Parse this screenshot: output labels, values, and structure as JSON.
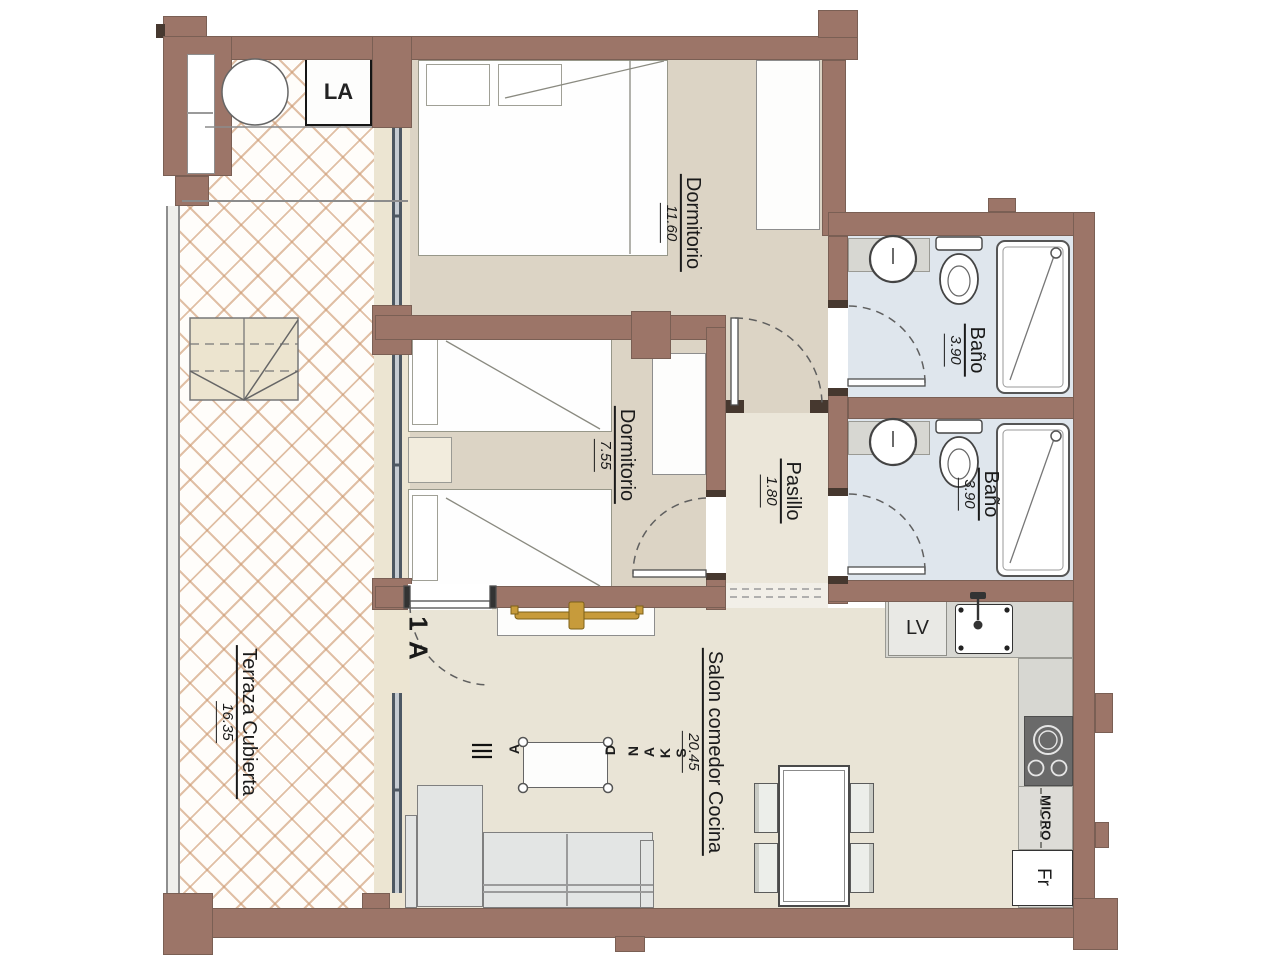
{
  "plan": {
    "unit_label": "1 A",
    "rooms": [
      {
        "id": "terraza",
        "name": "Terraza Cubierta",
        "area": "16.35"
      },
      {
        "id": "dormitorio_1",
        "name": "Dormitorio",
        "area": "11.60"
      },
      {
        "id": "dormitorio_2",
        "name": "Dormitorio",
        "area": "7.55"
      },
      {
        "id": "pasillo",
        "name": "Pasillo",
        "area": "1.80"
      },
      {
        "id": "bano_1",
        "name": "Baño",
        "area": "3.90"
      },
      {
        "id": "bano_2",
        "name": "Baño",
        "area": "3.90"
      },
      {
        "id": "salon",
        "name": "Salon comedor Cocina",
        "area": "20.45"
      }
    ],
    "appliances": {
      "washing_machine": "LA",
      "dishwasher": "LV",
      "microwave": "MICRO",
      "fridge": "Fr"
    },
    "watermark": {
      "letters": [
        "A",
        "D",
        "N",
        "A",
        "K",
        "S"
      ]
    },
    "colors": {
      "wall": "#9c7568",
      "wall_dark": "#46382f",
      "floor_beige": "#dcd4c5",
      "floor_cream": "#ebe6d9",
      "floor_bath": "#dfe6ed",
      "tile_grout": "#cb966c",
      "counter": "#d7d7d2",
      "cooktop": "#6a6a6a",
      "glass": "#4e5862",
      "gold": "#c79b3b",
      "sofa": "#e3e5e4"
    }
  }
}
